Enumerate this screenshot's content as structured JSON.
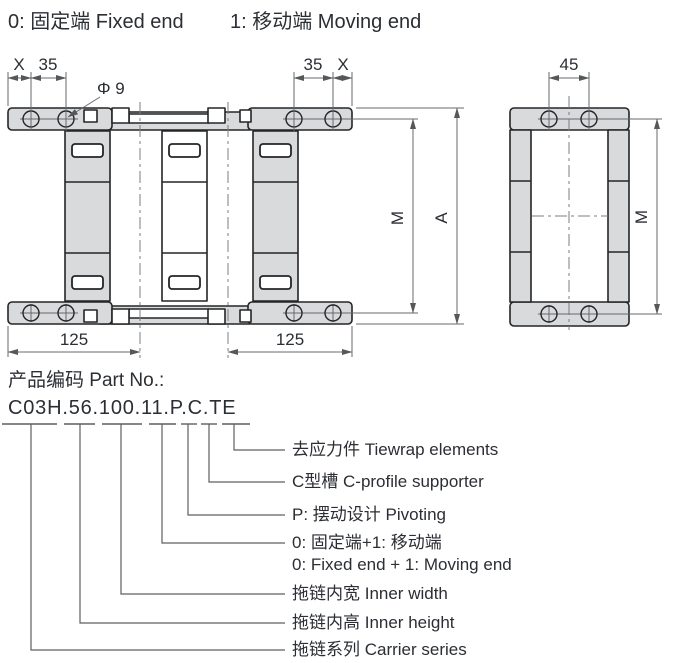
{
  "header": {
    "fixed_end": "0: 固定端 Fixed end",
    "moving_end": "1: 移动端 Moving end"
  },
  "drawing": {
    "top_left_dims": {
      "x": "X",
      "d35": "35"
    },
    "top_right_dims": {
      "d35": "35",
      "x": "X"
    },
    "hole_dia": "Φ 9",
    "side_top_dim": "45",
    "main_height_dims": {
      "m": "M",
      "a": "A"
    },
    "side_height_dim": "M",
    "bottom_dims": {
      "left": "125",
      "right": "125"
    },
    "colors": {
      "part_fill": "#d8dadc",
      "outline": "#232527",
      "dim_line": "#66696c",
      "text": "#2b2e33"
    }
  },
  "part_no": {
    "title": "产品编码 Part No.:",
    "code": "C03H.56.100.11.P.C.TE",
    "callouts": [
      {
        "label": "去应力件 Tiewrap elements"
      },
      {
        "label": "C型槽 C-profile supporter"
      },
      {
        "label": "P: 摆动设计 Pivoting"
      },
      {
        "label": "0: 固定端+1: 移动端",
        "label2": "0: Fixed end + 1: Moving end"
      },
      {
        "label": "拖链内宽 Inner width"
      },
      {
        "label": "拖链内高 Inner height"
      },
      {
        "label": "拖链系列 Carrier series"
      }
    ]
  }
}
